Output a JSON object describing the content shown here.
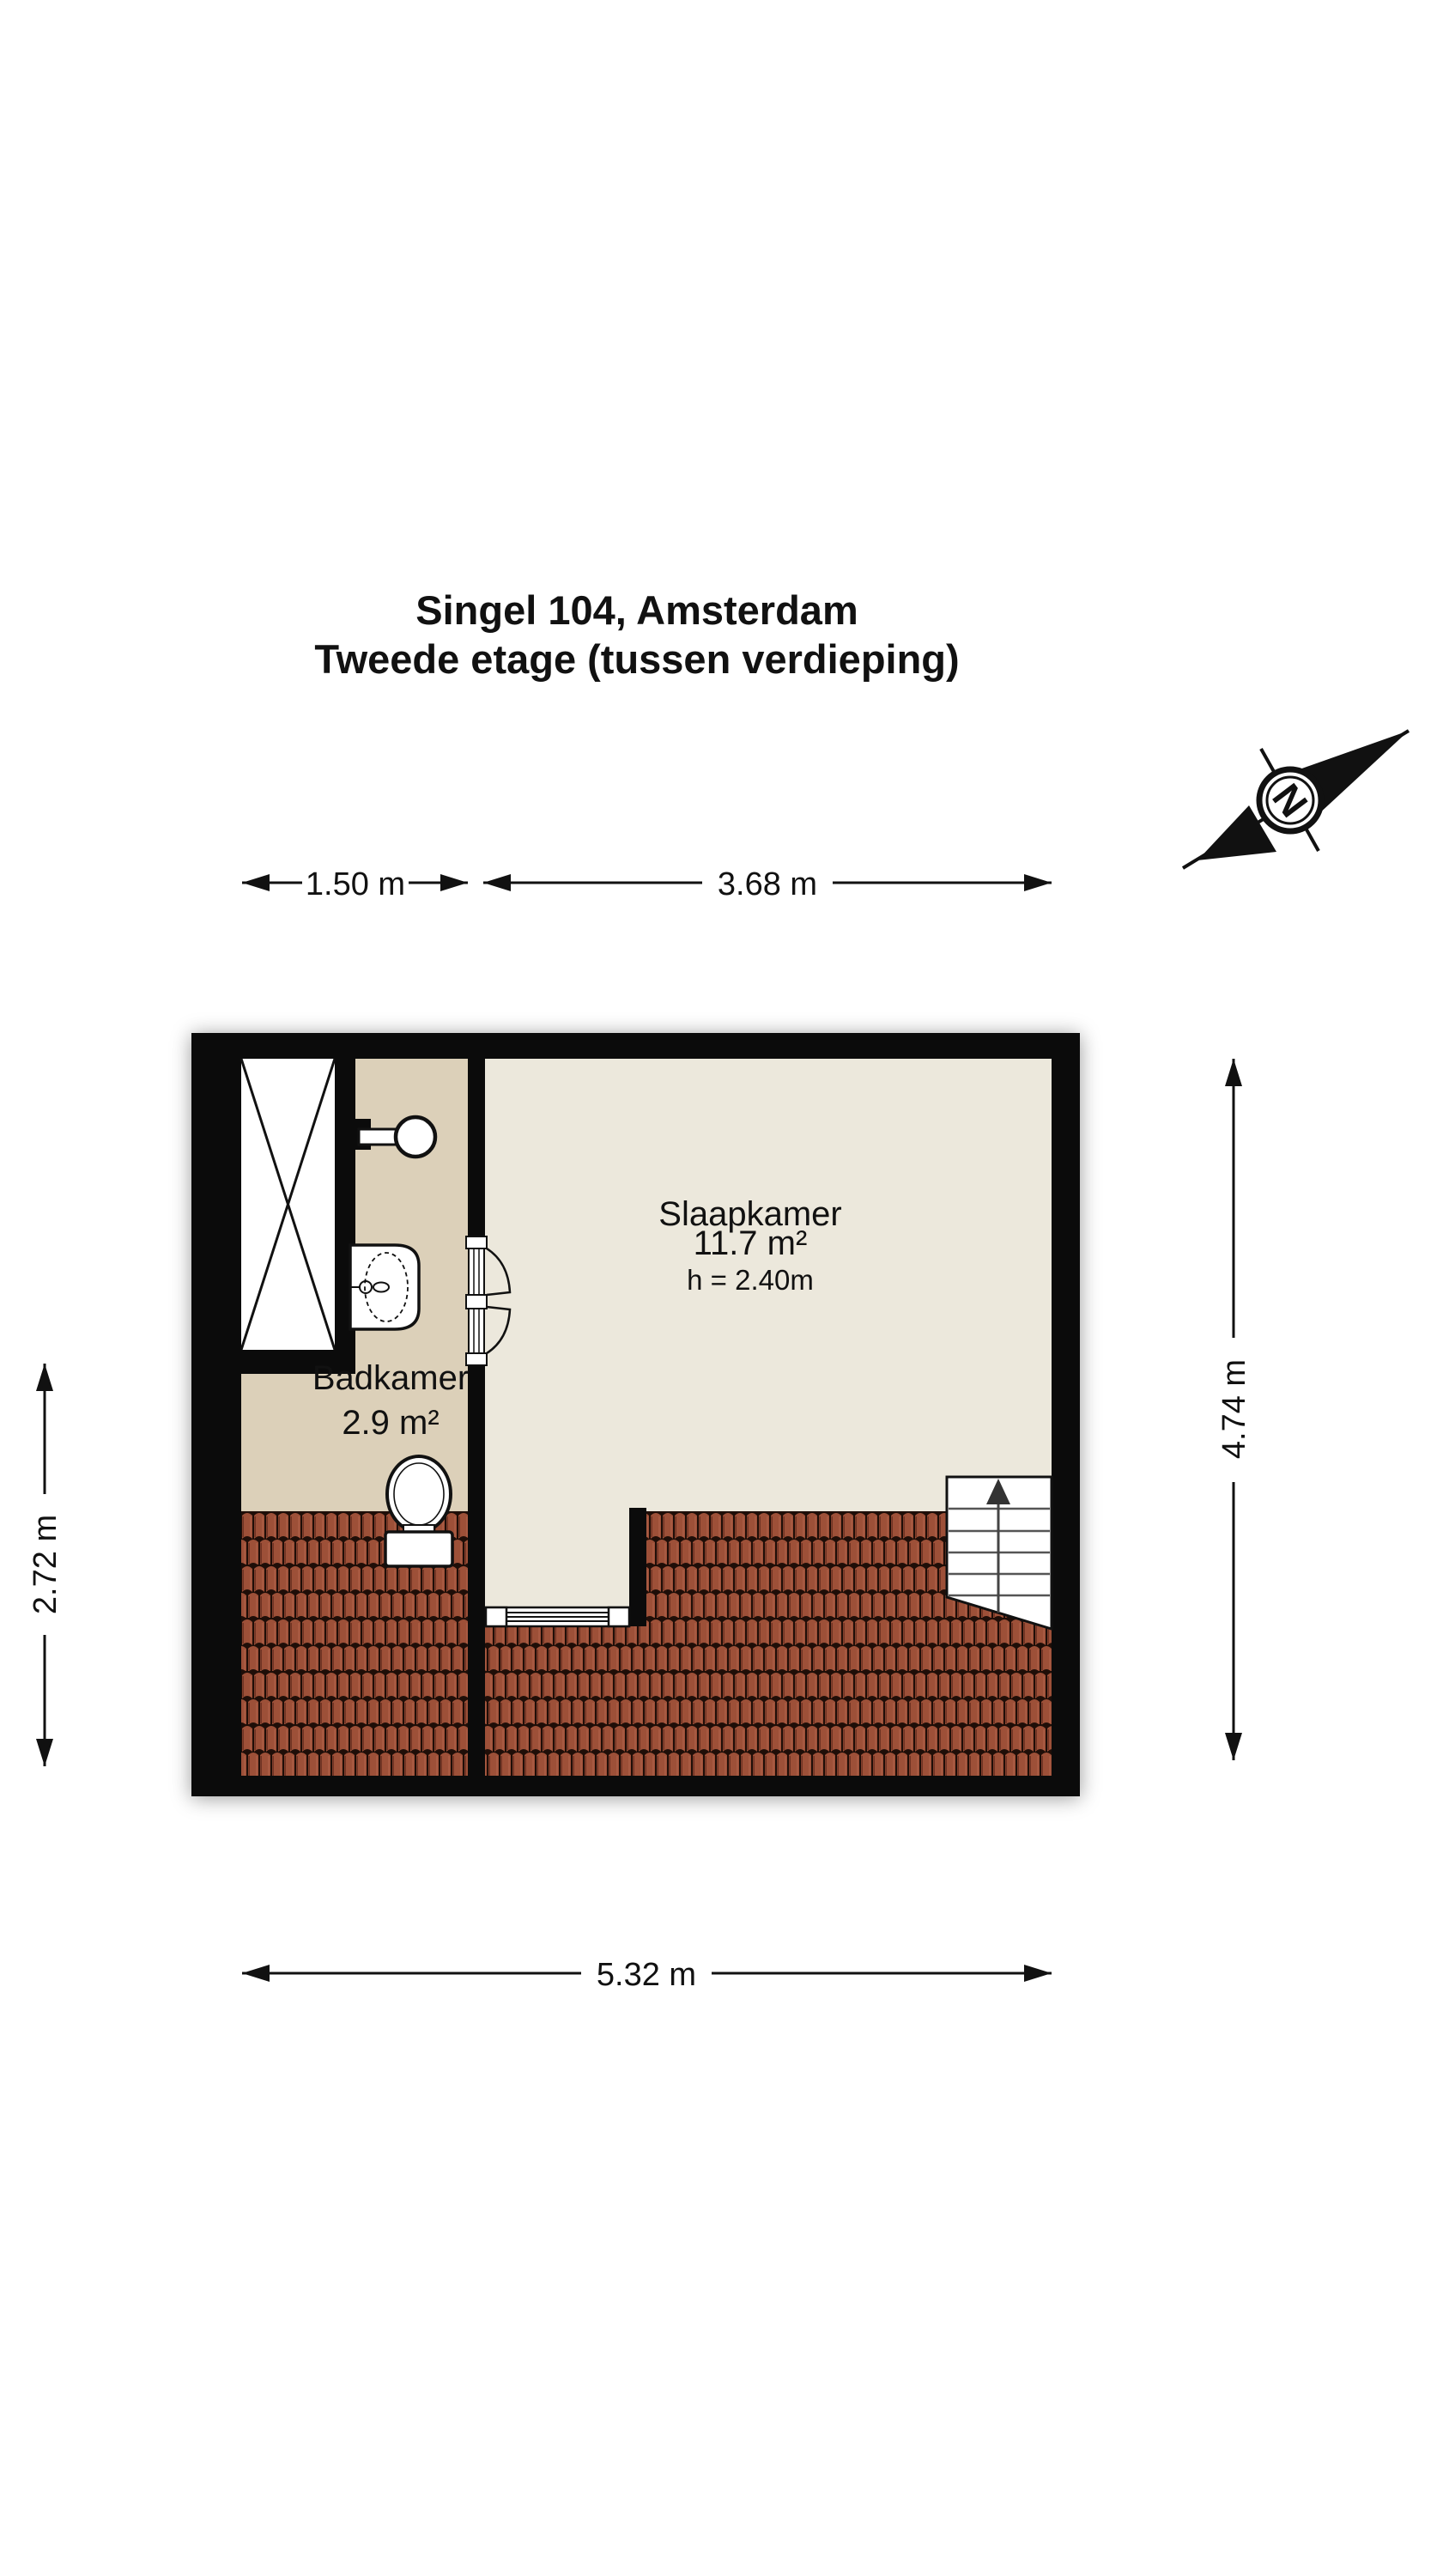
{
  "title": {
    "line1": "Singel 104, Amsterdam",
    "line2": "Tweede etage (tussen verdieping)"
  },
  "compass": {
    "label": "N"
  },
  "dimensions": {
    "top_bathroom": "1.50 m",
    "top_bedroom": "3.68 m",
    "left": "2.72 m",
    "right": "4.74 m",
    "bottom": "5.32 m"
  },
  "rooms": {
    "bedroom": {
      "name": "Slaapkamer",
      "area": "11.7 m²",
      "ceiling_height": "h = 2.40m"
    },
    "bathroom": {
      "name": "Badkamer",
      "area": "2.9 m²"
    }
  },
  "colors": {
    "wall": "#0b0b0b",
    "bedroom_floor": "#ECE8DC",
    "bathroom_floor": "#DCD0B9",
    "roof_tile": "#9D5038",
    "roof_tile_seam": "#1F0E08",
    "fixture": "#FFFFFF"
  }
}
